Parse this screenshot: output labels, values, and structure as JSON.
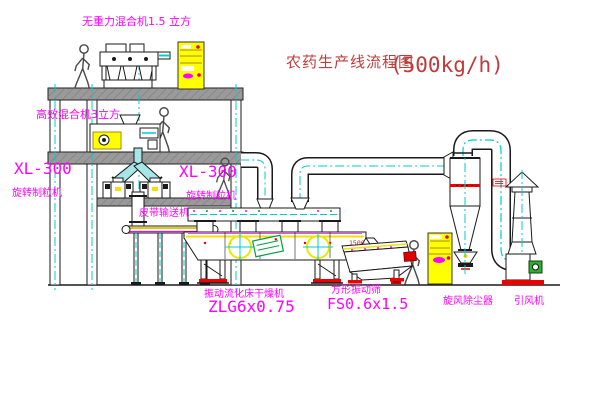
{
  "title": {
    "name": "农药生产线流程图",
    "capacity": "(500kg/h)"
  },
  "equipment_labels": {
    "gravity_free_mixer": "无重力混合机1.5 立方",
    "high_efficiency_mixer": "高效混合机3立方",
    "granulator_left": {
      "model": "XL-300",
      "name": "旋转制粒机"
    },
    "granulator_right": {
      "model": "XL-300",
      "name": "旋转制粒机"
    },
    "belt_conveyor": "皮带输送机",
    "fluid_bed_dryer": {
      "name": "振动流化床干燥机",
      "model": "ZLG6x0.75"
    },
    "vibrating_screen": {
      "name": "方形振动筛",
      "model": "FS0.6x1.5"
    },
    "cyclone_dust_collector": "旋风除尘器",
    "induced_draft_fan": "引风机"
  },
  "dimensions": {
    "screen_feed_height": "1500"
  },
  "colors": {
    "centerline_cyan": "#00cccc",
    "label_magenta": "#ff00ff",
    "title_red": "#c23b3b",
    "accent_red": "#ee0000",
    "cabinet_yellow": "#ffff00",
    "machine_yellow": "#f5e000",
    "motor_green": "#33aa33",
    "stamp_green": "#00a040",
    "beam_gray": "#9a9a9a",
    "line_black": "#1a1a1a",
    "background": "#ffffff"
  }
}
